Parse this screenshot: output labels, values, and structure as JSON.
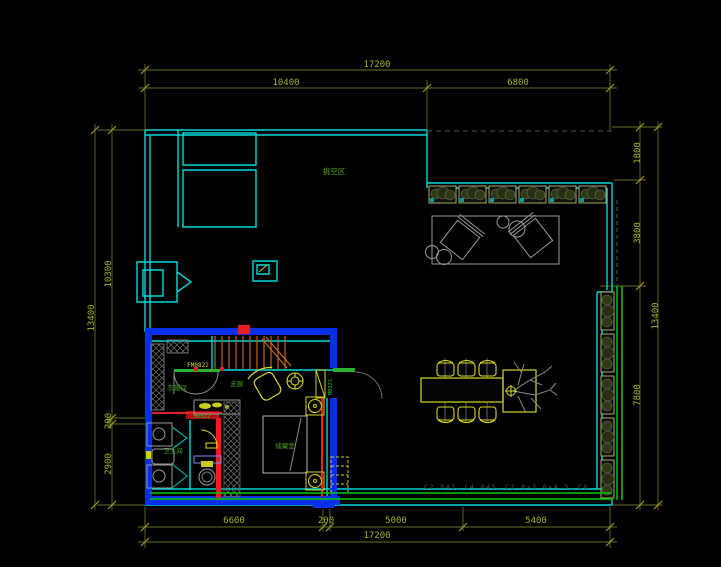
{
  "drawing": {
    "type": "floor-plan",
    "background": "#000000"
  },
  "colors": {
    "wall_cyan": "#00d9d9",
    "wall_blue": "#0630e8",
    "dim_line": "#6b6b22",
    "dim_text": "#a4b226",
    "label_green": "#5da219",
    "tag_yellow": "#d9d91f",
    "accent_red": "#e62020",
    "stair_orange": "#d2691e",
    "furniture_grey": "#9a9a9a",
    "landscape_green": "#00c800"
  },
  "dimensions": {
    "top": {
      "overall": "17200",
      "segments": [
        "10400",
        "6800"
      ]
    },
    "bottom": {
      "segments": [
        "6600",
        "200",
        "5000",
        "5400"
      ],
      "overall": "17200"
    },
    "left": {
      "overall": "13400",
      "segments": [
        "10300",
        "200",
        "2900"
      ]
    },
    "right": {
      "segments": [
        "1800",
        "3800",
        "7800"
      ],
      "overall": "13400"
    }
  },
  "labels": {
    "void_area": "挑空区",
    "cloakroom": "衣帽间",
    "corridor": "走廊",
    "bathroom": "卫生间",
    "storage": "储藏室",
    "door_tag_stair": "FM0822",
    "door_tag_bath": "M0822",
    "door_tag_entry": "M0921",
    "bottom_note": "C2.043、C4.045、C2.0×3.0×4.5、C6"
  }
}
